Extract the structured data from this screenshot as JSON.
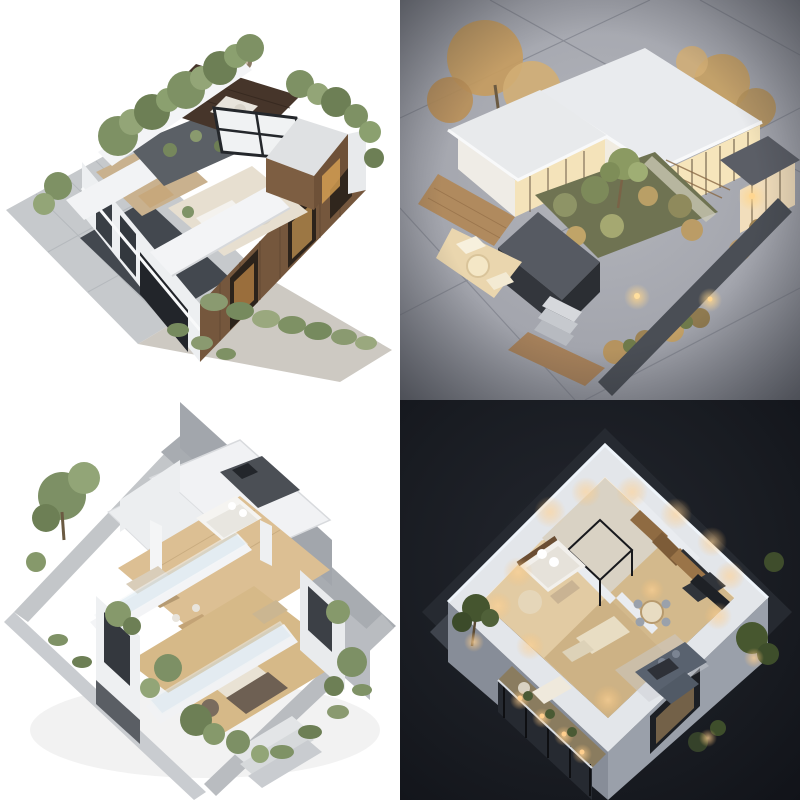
{
  "image_grid": {
    "rows": 2,
    "cols": 2,
    "panel_px": 400,
    "total_px": 800,
    "description": "2x2 grid of four AI-generated isometric 3D architectural renders of modern houses, no text or UI chrome visible"
  },
  "panels": [
    {
      "position": "top-left",
      "scene": "Daylight isometric aerial render of a modern two-storey villa with rooftop terrace garden, white parapets, vertical wood-slat facade, central skylight with dark cross frame, gray paved plaza, dark driveway, hedges and green trees on a white background",
      "background_color": "#ffffff",
      "palette": {
        "wood_facade": "#75573d",
        "walnut_deck": "#46352a",
        "parapet_white": "#f3f4f6",
        "foliage_green": "#7e9164",
        "plaza_gray": "#c6c9cc",
        "driveway_dark": "#43484f",
        "skylight_frame": "#24272b"
      }
    },
    {
      "position": "top-right",
      "scene": "Dusk isometric render of a flat-roofed modern house with warm glowing interiors, sunken courtyard garden, charcoal planter walls, wood deck and steps, golden autumn trees and path lights on gray concrete ground with seams and dark vignette",
      "background_color": "#9a9da5",
      "palette": {
        "concrete_ground": "#a7a9b0",
        "roof_slab": "#e9ebee",
        "interior_glow": "#f6e5bb",
        "charcoal_walls": "#33363c",
        "autumn_foliage": "#c59c60",
        "courtyard_green": "#7d8a5a",
        "deck_wood": "#b08a5e"
      }
    },
    {
      "position": "bottom-left",
      "scene": "Cutaway dollhouse-style isometric render of a two-storey modern home with exposed wood-floor interiors, bed and sofas, dining table, glass balustrades, white balcony slabs, concrete perimeter walls, front steps and green landscaping on a white background",
      "background_color": "#ffffff",
      "palette": {
        "wood_floor": "#dcbf93",
        "wall_white": "#eceef0",
        "concrete_gray": "#a2a6ac",
        "glass_blue": "#d7e6ef",
        "foliage_green": "#7d9065",
        "sofa_taupe": "#6e6053"
      }
    },
    {
      "position": "bottom-right",
      "scene": "Night isometric cutaway floor plan of a modern apartment with the roof removed, warm cove lighting, furnished master bedroom, wood kitchen, dining set, large dark sofa, black-framed glass partition, and a glass-railed balcony with uplit planters on a black background",
      "background_color": "#14161b",
      "palette": {
        "wall_white": "#e3e6ea",
        "floor_wood": "#dcc49c",
        "warm_light": "#ffd9a2",
        "sofa_dark": "#59626f",
        "ground_dark": "#262a31",
        "foliage_dark": "#45552f",
        "rim_light": "#eef4fa"
      }
    }
  ]
}
